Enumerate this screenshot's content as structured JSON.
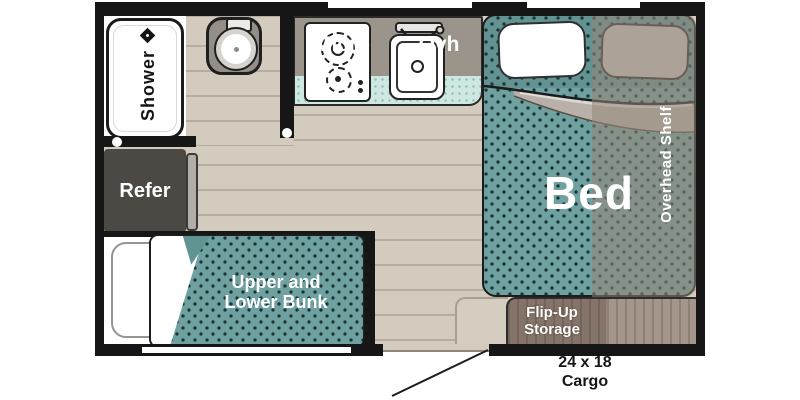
{
  "plan": {
    "type": "travel-trailer-floorplan",
    "labels": {
      "shower": "Shower",
      "micro": "Micro",
      "ovh": "Ovh",
      "bed": "Bed",
      "overhead_shelf": "Overhead Shelf",
      "refer": "Refer",
      "bunk_line1": "Upper and",
      "bunk_line2": "Lower Bunk",
      "flip_up_line1": "Flip-Up",
      "flip_up_line2": "Storage",
      "cargo_line1": "24 x 18",
      "cargo_line2": "Cargo"
    },
    "colors": {
      "wall": "#161616",
      "floor": "#d3cbbe",
      "plank_line": "#b6ada0",
      "counter_gray": "#9a948b",
      "counter_teal": "#cde7e2",
      "mattress_teal": "#6fa1a1",
      "mattress_dot": "#1d3434",
      "refer_dark": "#4c4843",
      "wood_dark": "#84746a",
      "wood_light": "#a4968b",
      "pillow_gray": "#cac3bc",
      "blanket_roll": "#b9b1a9",
      "text_white": "#ffffff",
      "text_black": "#161616"
    }
  }
}
